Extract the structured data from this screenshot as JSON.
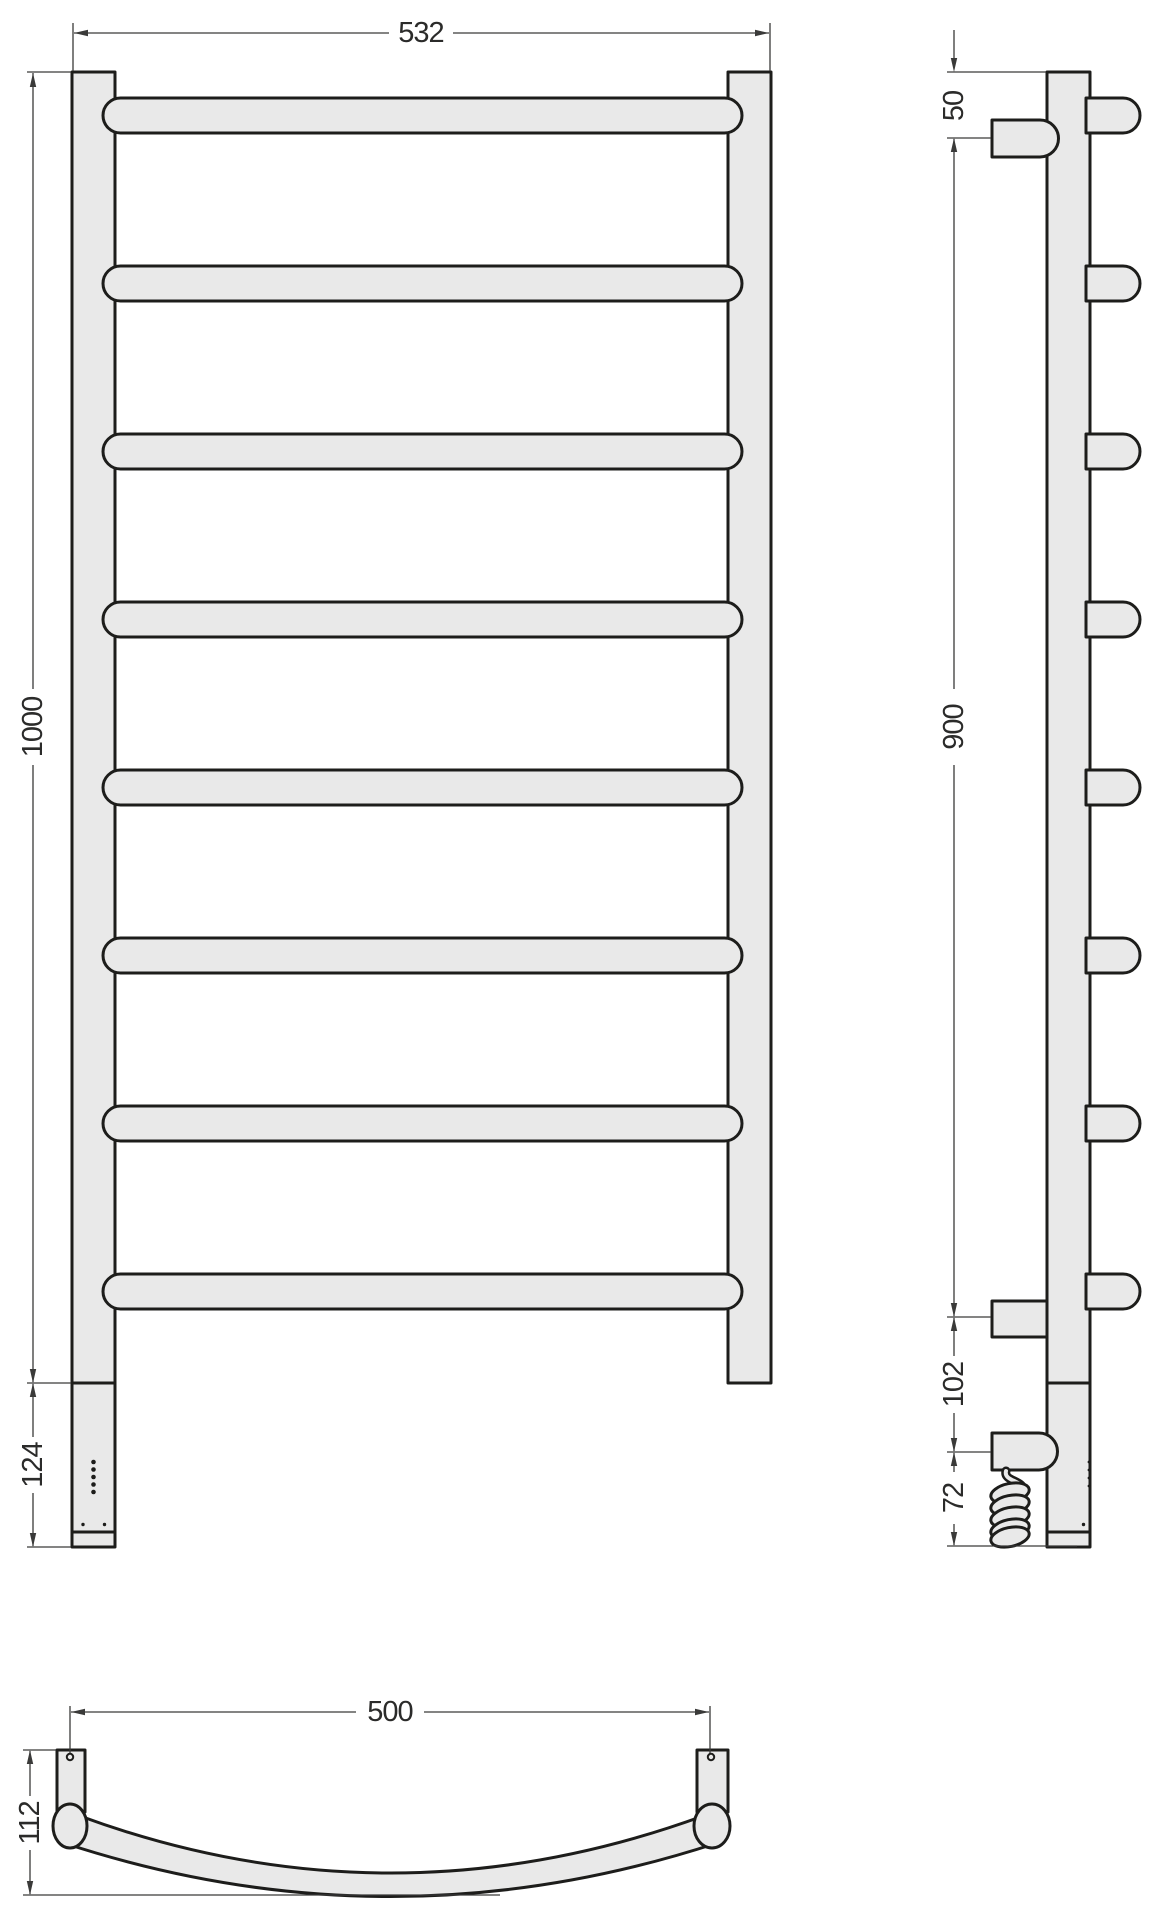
{
  "drawing": {
    "type": "technical-dimension-drawing",
    "subject": "ladder heated towel rail - front, side and top views",
    "units": "mm",
    "front_view": {
      "width": "532",
      "height": "1000",
      "heater_section_height": "124",
      "rung_count": 8
    },
    "side_view": {
      "top_to_upper_bracket": "50",
      "bracket_span": "900",
      "lower_bracket_to_heater": "102",
      "heater_to_cable_end": "72"
    },
    "top_view": {
      "mounting_span": "500",
      "depth": "112"
    },
    "colors": {
      "part_fill": "#e9e9e9",
      "part_outline": "#1d1d1b",
      "dimension_lines": "#3a3a39",
      "text": "#2b2b2a",
      "background": "#ffffff"
    }
  }
}
